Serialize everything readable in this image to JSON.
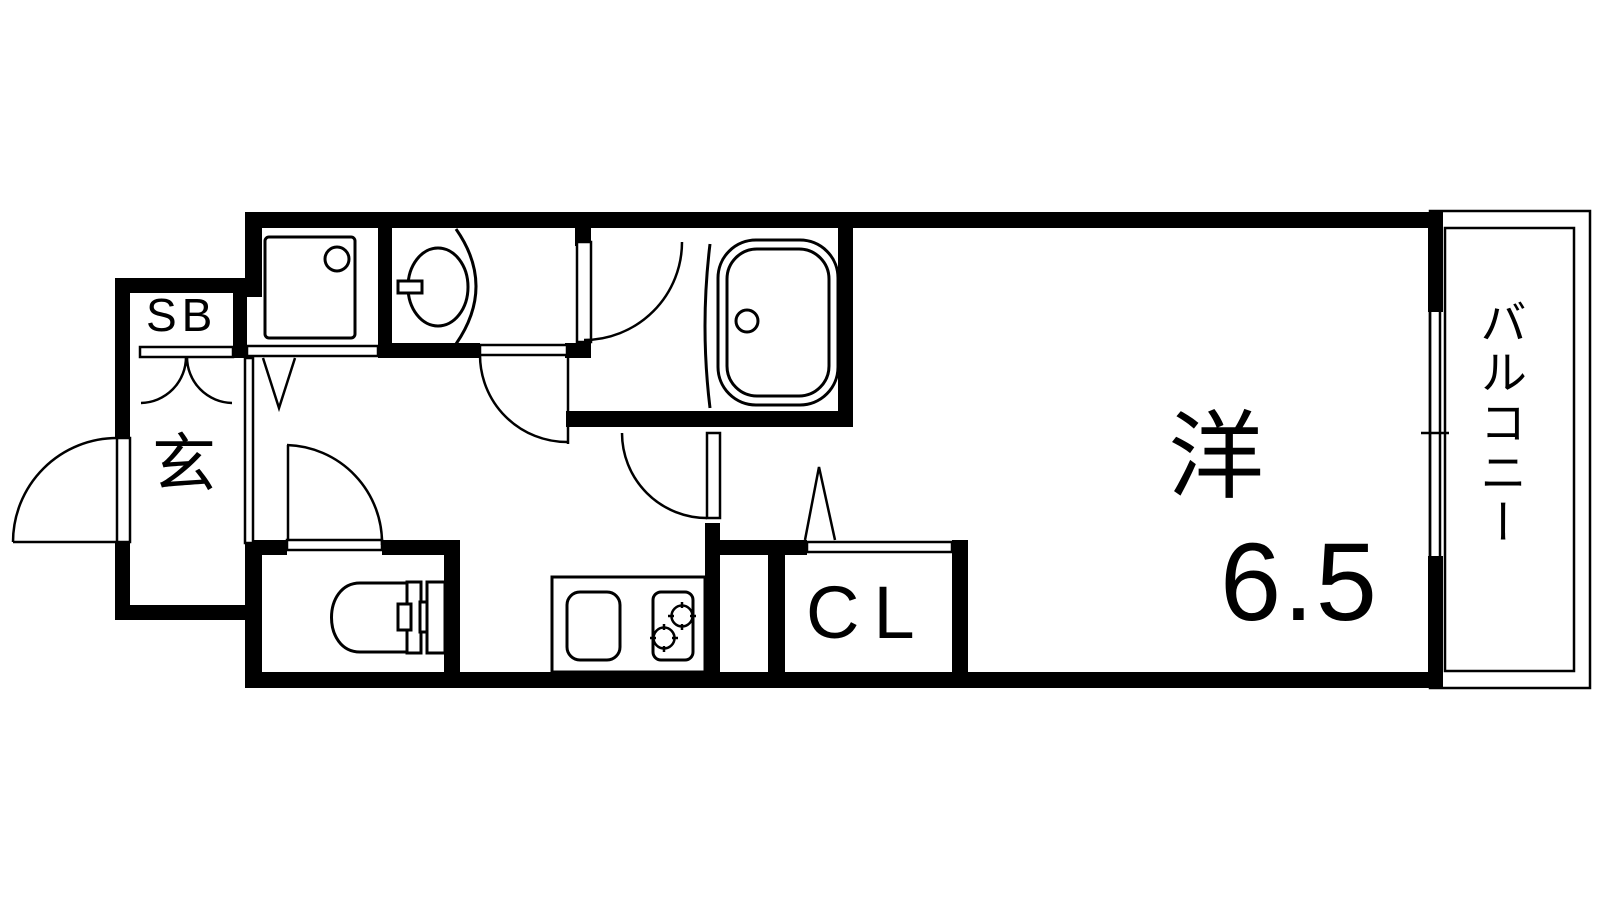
{
  "page": {
    "type": "apartment-floor-plan"
  },
  "labels": {
    "shoe_box": "SB",
    "entrance": "玄",
    "closet": "CL",
    "western_room": "洋",
    "western_room_size": "6.5",
    "balcony": "バルコニー"
  },
  "fixtures": [
    "washing-machine-pan",
    "washbasin",
    "bathtub",
    "toilet",
    "kitchen-sink",
    "gas-stove-2-burner",
    "sliding-window",
    "folding-door-marker",
    "hinged-doors"
  ],
  "colors": {
    "wall": "#000000",
    "line": "#000000",
    "background": "#ffffff"
  }
}
